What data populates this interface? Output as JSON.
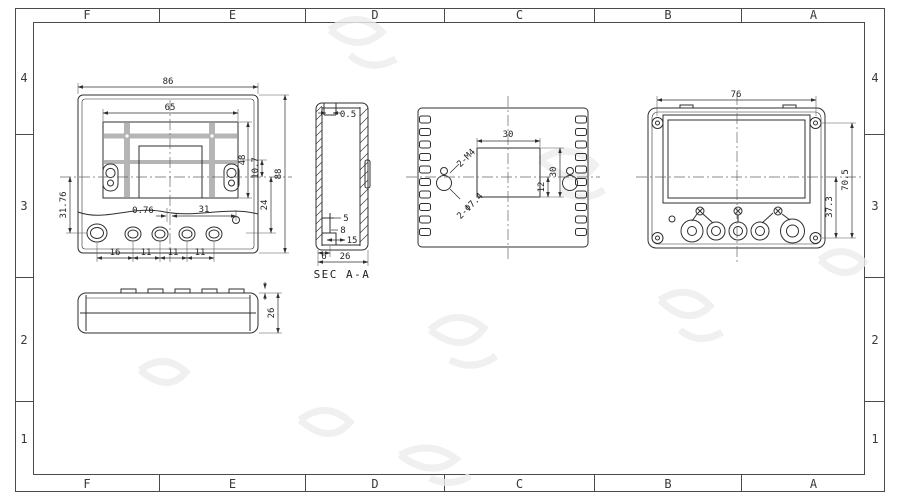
{
  "border": {
    "columns": [
      "F",
      "E",
      "D",
      "C",
      "B",
      "A"
    ],
    "rows": [
      "4",
      "3",
      "2",
      "1"
    ]
  },
  "views": {
    "front": {
      "dims": {
        "overall_width": "86",
        "panel_width": "65",
        "display_height": "48",
        "center_offset": "10.7",
        "overall_height": "88",
        "lower_height": "24",
        "left_span": "31.76",
        "button_offset": "0.76",
        "button_span": "31",
        "gap_large": "16",
        "gap_1": "11",
        "gap_2": "11",
        "gap_3": "11"
      }
    },
    "bottom": {
      "dims": {
        "depth": "26"
      }
    },
    "section": {
      "title": "SEC A-A",
      "dims": {
        "lip": "0.5",
        "rib": "5",
        "boss": "8",
        "inset": "15",
        "foot": "6",
        "depth": "26"
      }
    },
    "back": {
      "dims": {
        "cutout_width": "30",
        "cutout_height": "30",
        "cutout_offset": "12"
      },
      "notes": {
        "screw_thread": "2-M4",
        "hole_dia": "2-Φ7.4"
      }
    },
    "rear": {
      "dims": {
        "screw_span_w": "76",
        "screw_span_h": "70.5",
        "lower_span": "37.3"
      }
    }
  }
}
